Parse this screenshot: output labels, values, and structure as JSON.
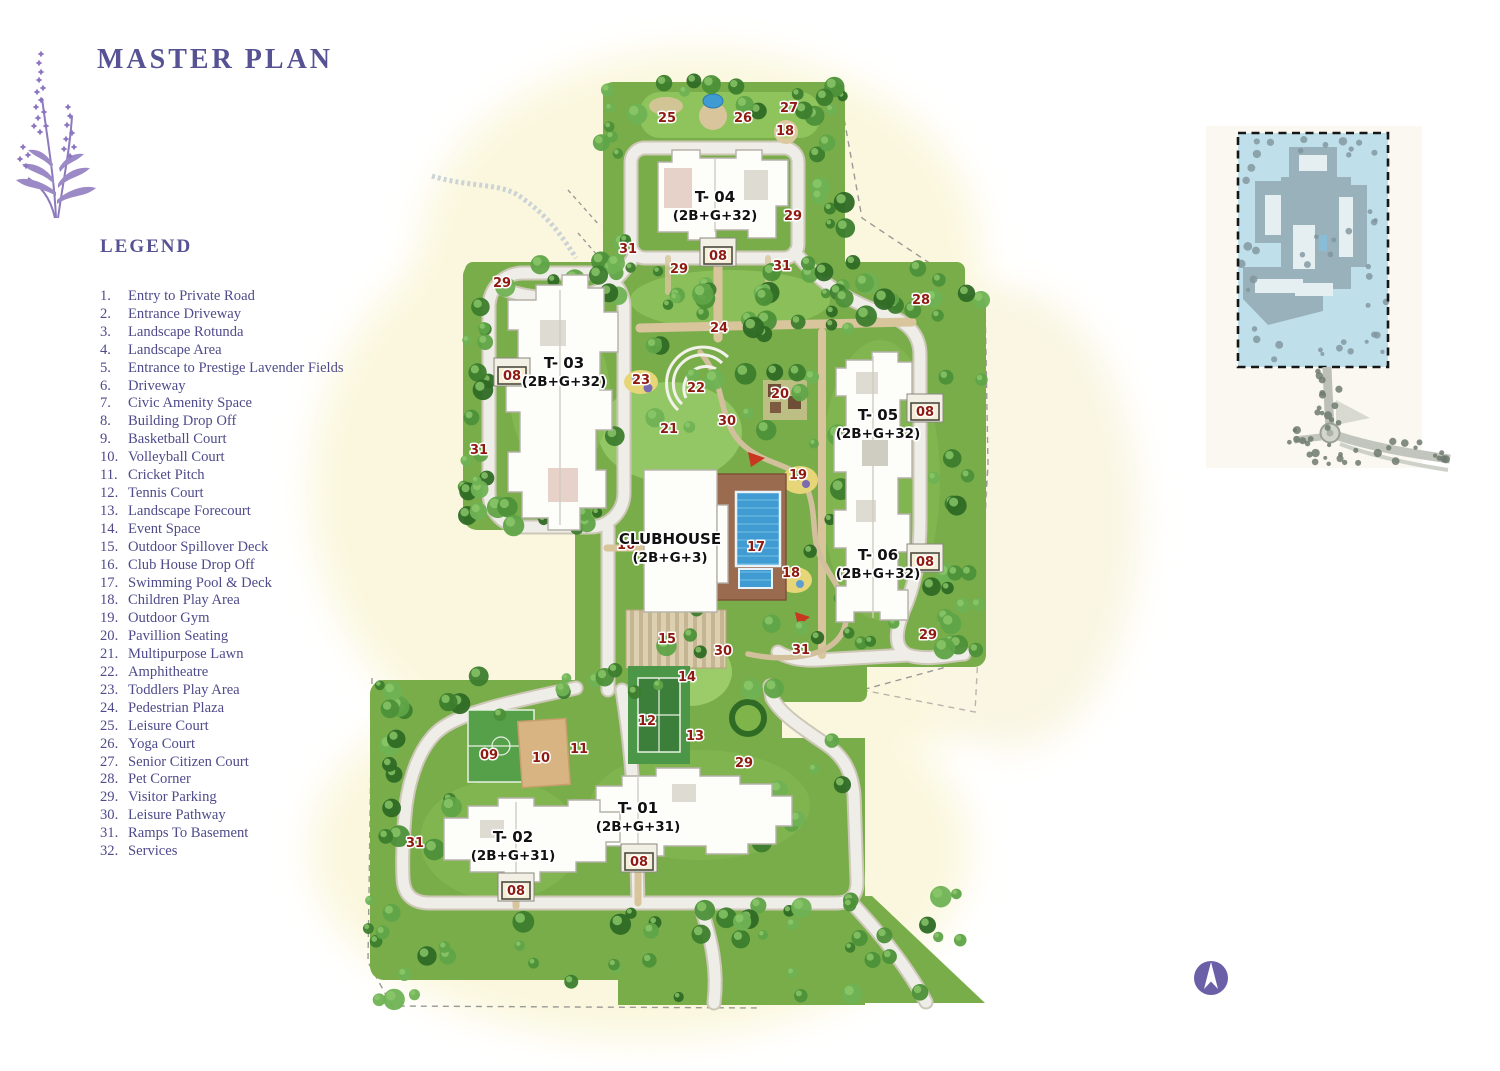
{
  "page": {
    "title": "MASTER PLAN"
  },
  "legend": {
    "heading": "LEGEND",
    "items": [
      {
        "num": "1.",
        "label": "Entry to Private Road"
      },
      {
        "num": "2.",
        "label": "Entrance Driveway"
      },
      {
        "num": "3.",
        "label": "Landscape Rotunda"
      },
      {
        "num": "4.",
        "label": "Landscape Area"
      },
      {
        "num": "5.",
        "label": "Entrance to Prestige Lavender Fields"
      },
      {
        "num": "6.",
        "label": "Driveway"
      },
      {
        "num": "7.",
        "label": "Civic Amenity Space"
      },
      {
        "num": "8.",
        "label": "Building Drop Off"
      },
      {
        "num": "9.",
        "label": "Basketball Court"
      },
      {
        "num": "10.",
        "label": "Volleyball Court"
      },
      {
        "num": "11.",
        "label": "Cricket Pitch"
      },
      {
        "num": "12.",
        "label": "Tennis Court"
      },
      {
        "num": "13.",
        "label": "Landscape Forecourt"
      },
      {
        "num": "14.",
        "label": "Event Space"
      },
      {
        "num": "15.",
        "label": "Outdoor Spillover Deck"
      },
      {
        "num": "16.",
        "label": "Club House Drop Off"
      },
      {
        "num": "17.",
        "label": "Swimming Pool & Deck"
      },
      {
        "num": "18.",
        "label": "Children Play Area"
      },
      {
        "num": "19.",
        "label": "Outdoor Gym"
      },
      {
        "num": "20.",
        "label": "Pavillion Seating"
      },
      {
        "num": "21.",
        "label": "Multipurpose Lawn"
      },
      {
        "num": "22.",
        "label": "Amphitheatre"
      },
      {
        "num": "23.",
        "label": "Toddlers Play Area"
      },
      {
        "num": "24.",
        "label": "Pedestrian Plaza"
      },
      {
        "num": "25.",
        "label": "Leisure Court"
      },
      {
        "num": "26.",
        "label": "Yoga Court"
      },
      {
        "num": "27.",
        "label": "Senior Citizen Court"
      },
      {
        "num": "28.",
        "label": "Pet Corner"
      },
      {
        "num": "29.",
        "label": "Visitor Parking"
      },
      {
        "num": "30.",
        "label": "Leisure Pathway"
      },
      {
        "num": "31.",
        "label": "Ramps To Basement"
      },
      {
        "num": "32.",
        "label": "Services"
      }
    ]
  },
  "site_map": {
    "marker_color": "#8e1a10",
    "towers": [
      {
        "name": "T- 04",
        "spec": "(2B+G+32)",
        "x": 715,
        "y": 202
      },
      {
        "name": "T- 03",
        "spec": "(2B+G+32)",
        "x": 564,
        "y": 368
      },
      {
        "name": "T- 05",
        "spec": "(2B+G+32)",
        "x": 878,
        "y": 420
      },
      {
        "name": "T- 06",
        "spec": "(2B+G+32)",
        "x": 878,
        "y": 560
      },
      {
        "name": "T- 01",
        "spec": "(2B+G+31)",
        "x": 638,
        "y": 813
      },
      {
        "name": "T- 02",
        "spec": "(2B+G+31)",
        "x": 513,
        "y": 842
      }
    ],
    "clubhouse": {
      "name": "CLUBHOUSE",
      "spec": "(2B+G+3)",
      "x": 670,
      "y": 544
    },
    "markers": [
      {
        "label": "25",
        "x": 667,
        "y": 122
      },
      {
        "label": "26",
        "x": 743,
        "y": 122
      },
      {
        "label": "27",
        "x": 789,
        "y": 112
      },
      {
        "label": "18",
        "x": 785,
        "y": 135
      },
      {
        "label": "29",
        "x": 793,
        "y": 220
      },
      {
        "label": "31",
        "x": 628,
        "y": 253
      },
      {
        "label": "08",
        "x": 718,
        "y": 260,
        "boxed": true
      },
      {
        "label": "29",
        "x": 679,
        "y": 273
      },
      {
        "label": "31",
        "x": 782,
        "y": 270
      },
      {
        "label": "29",
        "x": 502,
        "y": 287
      },
      {
        "label": "28",
        "x": 921,
        "y": 304
      },
      {
        "label": "24",
        "x": 719,
        "y": 332
      },
      {
        "label": "08",
        "x": 512,
        "y": 380,
        "boxed": true
      },
      {
        "label": "23",
        "x": 641,
        "y": 384
      },
      {
        "label": "22",
        "x": 696,
        "y": 392
      },
      {
        "label": "20",
        "x": 780,
        "y": 398
      },
      {
        "label": "08",
        "x": 925,
        "y": 416,
        "boxed": true
      },
      {
        "label": "30",
        "x": 727,
        "y": 425
      },
      {
        "label": "21",
        "x": 669,
        "y": 433
      },
      {
        "label": "31",
        "x": 479,
        "y": 454
      },
      {
        "label": "19",
        "x": 798,
        "y": 479
      },
      {
        "label": "16",
        "x": 626,
        "y": 549
      },
      {
        "label": "17",
        "x": 756,
        "y": 551
      },
      {
        "label": "18",
        "x": 791,
        "y": 577
      },
      {
        "label": "08",
        "x": 925,
        "y": 566,
        "boxed": true
      },
      {
        "label": "15",
        "x": 667,
        "y": 643
      },
      {
        "label": "30",
        "x": 723,
        "y": 655
      },
      {
        "label": "31",
        "x": 801,
        "y": 654
      },
      {
        "label": "29",
        "x": 928,
        "y": 639
      },
      {
        "label": "14",
        "x": 687,
        "y": 681
      },
      {
        "label": "12",
        "x": 647,
        "y": 725
      },
      {
        "label": "13",
        "x": 695,
        "y": 740
      },
      {
        "label": "29",
        "x": 744,
        "y": 767
      },
      {
        "label": "09",
        "x": 489,
        "y": 759
      },
      {
        "label": "10",
        "x": 541,
        "y": 762
      },
      {
        "label": "11",
        "x": 579,
        "y": 753
      },
      {
        "label": "31",
        "x": 415,
        "y": 847
      },
      {
        "label": "08",
        "x": 639,
        "y": 866,
        "boxed": true
      },
      {
        "label": "08",
        "x": 516,
        "y": 895,
        "boxed": true
      }
    ]
  },
  "icons": {
    "compass": "north-arrow-icon",
    "brand_flower": "lavender-sprig-icon"
  },
  "colors": {
    "title_purple": "#565293",
    "legend_purple": "#4f4b8b",
    "marker_red": "#8e1a10",
    "compass_purple": "#6b60a8",
    "inset_blue": "#bfe0ea"
  }
}
